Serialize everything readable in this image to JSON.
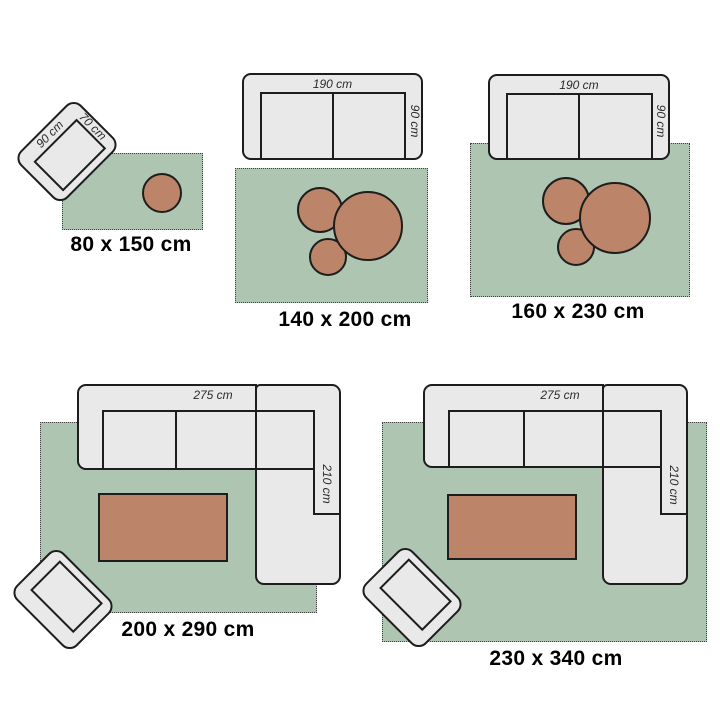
{
  "title": "Rug size guide with furniture for scale",
  "colors": {
    "background": "#ffffff",
    "rug_green": "#aec5b1",
    "rug_border": "#3f3f3f",
    "table_brown": "#bc8569",
    "furniture_grey": "#e9e9e9",
    "outline": "#1d1d1d",
    "dim_text": "#2b2b2b",
    "label_black": "#000000"
  },
  "sections": [
    {
      "id": "80x150",
      "size_label": "80 x 150 cm",
      "furniture": [
        "armchair",
        "round side table"
      ],
      "chair": {
        "width_label": "90 cm",
        "depth_label": "70 cm"
      }
    },
    {
      "id": "140x200",
      "size_label": "140 x 200 cm",
      "furniture": [
        "two-seater sofa",
        "nesting tables"
      ],
      "sofa": {
        "width_label": "190 cm",
        "depth_label": "90 cm"
      }
    },
    {
      "id": "160x230",
      "size_label": "160 x 230 cm",
      "furniture": [
        "two-seater sofa",
        "nesting tables"
      ],
      "sofa": {
        "width_label": "190 cm",
        "depth_label": "90 cm"
      }
    },
    {
      "id": "200x290",
      "size_label": "200 x 290 cm",
      "furniture": [
        "corner sofa",
        "coffee table",
        "armchair"
      ],
      "sofa": {
        "width_label": "275 cm",
        "depth_label": "210 cm"
      }
    },
    {
      "id": "230x340",
      "size_label": "230 x 340 cm",
      "furniture": [
        "corner sofa",
        "coffee table",
        "armchair"
      ],
      "sofa": {
        "width_label": "275 cm",
        "depth_label": "210 cm"
      }
    }
  ]
}
